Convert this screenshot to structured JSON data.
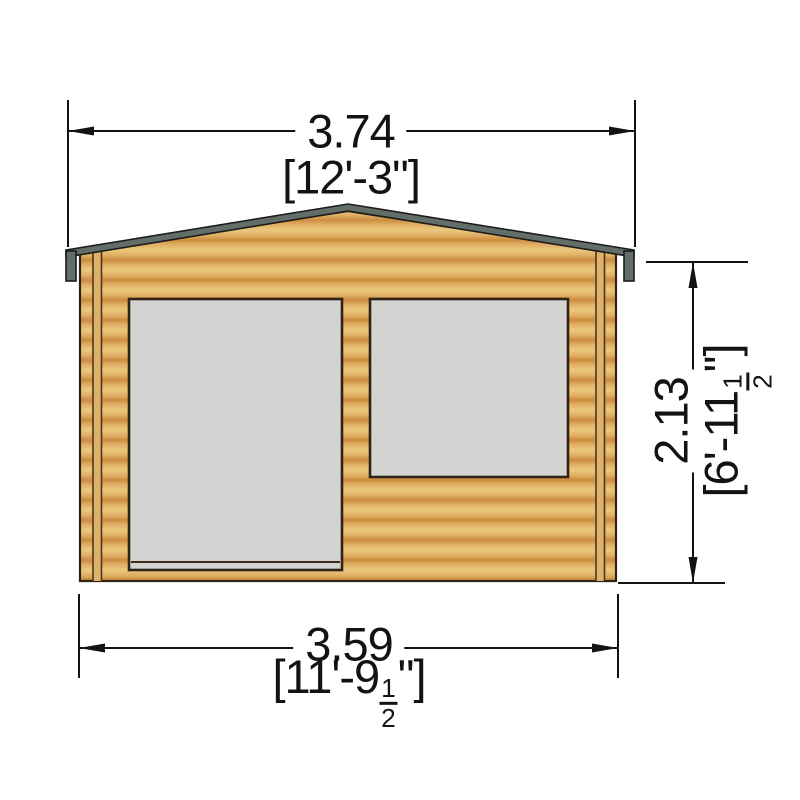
{
  "drawing": {
    "colors": {
      "background": "#ffffff",
      "wood_dark": "#cd8c3f",
      "wood_mid": "#dfae62",
      "wood_light": "#eac87e",
      "corner_trim_light": "#e0b269",
      "fascia_gray": "#636e69",
      "glass_gray": "#d3d3d1",
      "outline_brown": "#2e2315",
      "dim_black": "#131313"
    },
    "dimensions": {
      "roof_width": {
        "metric": "3.74",
        "imperial": "[12'-3\"]"
      },
      "wall_width": {
        "metric": "3.59",
        "imperial_prefix": "[11'-9",
        "fraction_numerator": "1",
        "fraction_denominator": "2",
        "imperial_suffix": "\"]"
      },
      "wall_height": {
        "metric": "2.13",
        "imperial_prefix": "[6'-11",
        "fraction_numerator": "1",
        "fraction_denominator": "2",
        "imperial_suffix": "\"]"
      }
    }
  }
}
